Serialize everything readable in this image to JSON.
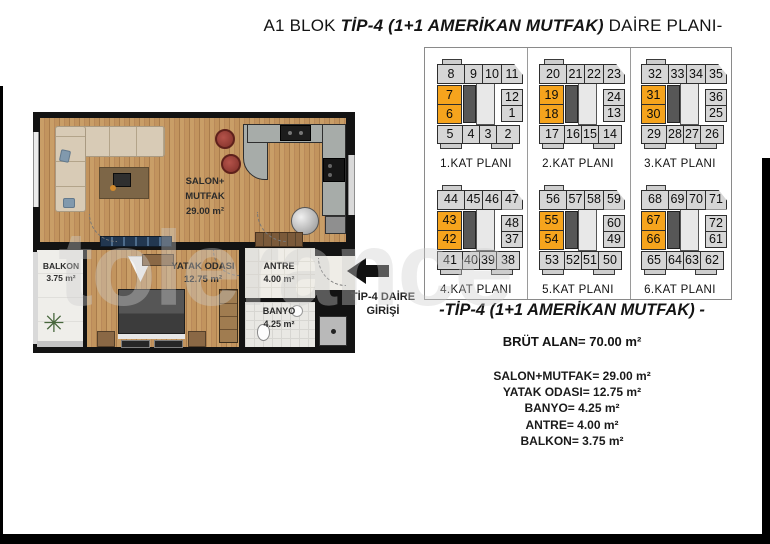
{
  "title": {
    "prefix": "A1 BLOK ",
    "emphasis": "TİP-4 (1+1 AMERİKAN MUTFAK)",
    "suffix": " DAİRE PLANI-"
  },
  "floor_plan": {
    "rooms": {
      "salon": {
        "name_line1": "SALON+",
        "name_line2": "MUTFAK",
        "area": "29.00 m²"
      },
      "yatak": {
        "name": "YATAK ODASI",
        "area": "12.75 m²"
      },
      "antre": {
        "name": "ANTRE",
        "area": "4.00 m²"
      },
      "banyo": {
        "name": "BANYO",
        "area": "4.25 m²"
      },
      "balkon": {
        "name": "BALKON",
        "area": "3.75 m²"
      }
    },
    "entrance_label_line1": "TİP-4 DAİRE",
    "entrance_label_line2": "GİRİŞİ"
  },
  "key_plans": {
    "highlight_color": "#F6A41D",
    "floors": [
      {
        "label": "1.KAT PLANI",
        "top": [
          "8",
          "9",
          "10",
          "11"
        ],
        "left": [
          "7",
          "6"
        ],
        "right": [
          "12",
          "1"
        ],
        "bottom": [
          "5",
          "4",
          "3",
          "2"
        ]
      },
      {
        "label": "2.KAT PLANI",
        "top": [
          "20",
          "21",
          "22",
          "23"
        ],
        "left": [
          "19",
          "18"
        ],
        "right": [
          "24",
          "13"
        ],
        "bottom": [
          "17",
          "16",
          "15",
          "14"
        ]
      },
      {
        "label": "3.KAT PLANI",
        "top": [
          "32",
          "33",
          "34",
          "35"
        ],
        "left": [
          "31",
          "30"
        ],
        "right": [
          "36",
          "25"
        ],
        "bottom": [
          "29",
          "28",
          "27",
          "26"
        ]
      },
      {
        "label": "4.KAT PLANI",
        "top": [
          "44",
          "45",
          "46",
          "47"
        ],
        "left": [
          "43",
          "42"
        ],
        "right": [
          "48",
          "37"
        ],
        "bottom": [
          "41",
          "40",
          "39",
          "38"
        ]
      },
      {
        "label": "5.KAT PLANI",
        "top": [
          "56",
          "57",
          "58",
          "59"
        ],
        "left": [
          "55",
          "54"
        ],
        "right": [
          "60",
          "49"
        ],
        "bottom": [
          "53",
          "52",
          "51",
          "50"
        ]
      },
      {
        "label": "6.KAT PLANI",
        "top": [
          "68",
          "69",
          "70",
          "71"
        ],
        "left": [
          "67",
          "66"
        ],
        "right": [
          "72",
          "61"
        ],
        "bottom": [
          "65",
          "64",
          "63",
          "62"
        ]
      }
    ]
  },
  "summary": {
    "heading": "-TİP-4 (1+1 AMERİKAN MUTFAK) -",
    "gross_area": "BRÜT ALAN= 70.00 m²",
    "items": [
      "SALON+MUTFAK= 29.00 m²",
      "YATAK ODASI= 12.75 m²",
      "BANYO= 4.25 m²",
      "ANTRE= 4.00 m²",
      "BALKON= 3.75 m²"
    ]
  },
  "icons": {
    "plant": "✳"
  },
  "watermark": "tolerance",
  "colors": {
    "highlight": "#F6A41D",
    "wall": "#131313",
    "wood": "#C2945E",
    "counter": "#A7ACA9"
  }
}
